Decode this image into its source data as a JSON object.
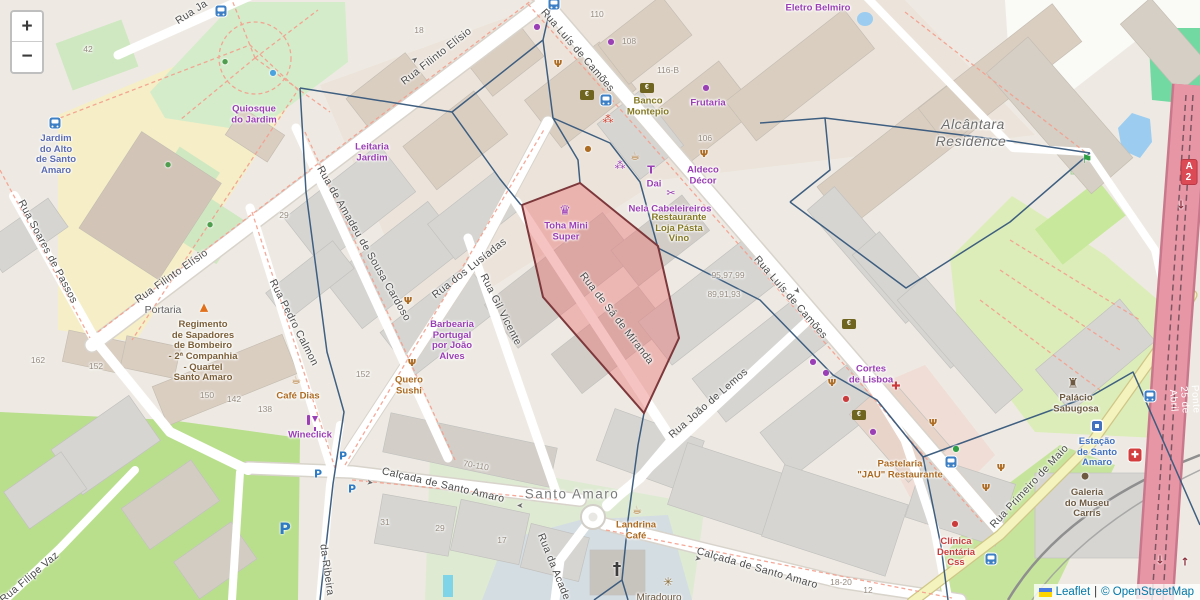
{
  "controls": {
    "zoom_in": "+",
    "zoom_out": "−"
  },
  "shield": {
    "text": "A 2"
  },
  "attribution": {
    "leaflet": "Leaflet",
    "separator": "|",
    "copyright": "© OpenStreetMap"
  },
  "colors": {
    "highlight_fill": "#e96f6f",
    "highlight_stroke": "#7d383c",
    "boundary_mesh": "#36587c",
    "motorway": "#e796a6",
    "road": "#ffffff",
    "secondary_road": "#f4f3bd",
    "park": "#d4ecca",
    "field": "#b9df8d",
    "water": "#9ccdf0",
    "poi_purple": "#9a3fb5",
    "poi_orange": "#ad6b21",
    "poi_olive": "#857a24",
    "poi_brown": "#6d5a41",
    "poi_red": "#cc3b3c",
    "poi_blue": "#4372c0",
    "transit_blue": "#3d7fc4"
  },
  "streets": [
    {
      "text": "Rua Ja"
    },
    {
      "text": "Rua Filinto Elísio"
    },
    {
      "text": "Rua Filinto Elísio"
    },
    {
      "text": "Rua Soares de Passos"
    },
    {
      "text": "Rua Luís de Camões"
    },
    {
      "text": "Rua Luís de Camões"
    },
    {
      "text": "Rua de Amadeu de Sousa Cardoso"
    },
    {
      "text": "Rua dos Lusíadas"
    },
    {
      "text": "Rua Gil Vicente"
    },
    {
      "text": "Rua Pedro Calmon"
    },
    {
      "text": "Rua de Sá de Miranda"
    },
    {
      "text": "Rua João de Lemos"
    },
    {
      "text": "Calçada de Santo Amaro"
    },
    {
      "text": "Calçada de Santo Amaro"
    },
    {
      "text": "Rua da Acade"
    },
    {
      "text": "da Ribeira"
    },
    {
      "text": "Rua Filipe Vaz"
    },
    {
      "text": "Rua Primeiro de Maio"
    },
    {
      "text": "Ponte 25 de Abril"
    }
  ],
  "places": [
    {
      "text": "Santo Amaro"
    },
    {
      "text": "Alcântara"
    },
    {
      "text": "Residence"
    },
    {
      "text": "Miradouro"
    }
  ],
  "pois": [
    {
      "text": "Quiosque\ndo Jardim"
    },
    {
      "text": "Jardim\ndo Alto\nde Santo\nAmaro"
    },
    {
      "text": "Leitaria\nJardim"
    },
    {
      "text": "Banco\nMontepio"
    },
    {
      "text": "Frutaria"
    },
    {
      "text": "Aldeco\nDécor"
    },
    {
      "text": "Dai"
    },
    {
      "text": "Nela Cabeleireiros"
    },
    {
      "text": "Restaurante\nLoja Pásta\nVino"
    },
    {
      "text": "Toha Mini\nSuper"
    },
    {
      "text": "Barbearia\nPortugal\npor João\nAlves"
    },
    {
      "text": "Quero\nSushi"
    },
    {
      "text": "Café Dias"
    },
    {
      "text": "Wineclick"
    },
    {
      "text": "Portaria"
    },
    {
      "text": "Regimento\nde Sapadores\nde Bombeiro\n- 2ª Companhia\n- Quartel\nSanto Amaro"
    },
    {
      "text": "Cortes\nde Lisboa"
    },
    {
      "text": "Pastelaria\n\"JAU\" Restaurante"
    },
    {
      "text": "Clínica\nDentária\nCss"
    },
    {
      "text": "Palácio\nSabugosa"
    },
    {
      "text": "Estação\nde Santo\nAmaro"
    },
    {
      "text": "Galeria\ndo Museu\nCarris"
    },
    {
      "text": "Eletro Belmiro"
    },
    {
      "text": "Landrina\nCafé"
    }
  ],
  "housenumbers": [
    "42",
    "18",
    "110",
    "108",
    "116-B",
    "106",
    "95,97,99",
    "89,91,93",
    "29",
    "162",
    "152",
    "152",
    "150",
    "142",
    "138",
    "31",
    "29",
    "17",
    "18-20",
    "12",
    "70-110"
  ],
  "icon_glyphs": {
    "cafe": "☕",
    "restaurant": "Ψ",
    "supermarket": "♛",
    "church": "†",
    "viewpoint": "✳",
    "playground": "⚑",
    "castle": "♜",
    "fire": "▲",
    "cross": "✚",
    "paw": "⁂",
    "clothes": "T",
    "scissors": "✂",
    "dot": "●",
    "parking": "P",
    "euro": "€",
    "arrow": "➤",
    "arrow_down": "↓",
    "arrow_up": "↑"
  }
}
